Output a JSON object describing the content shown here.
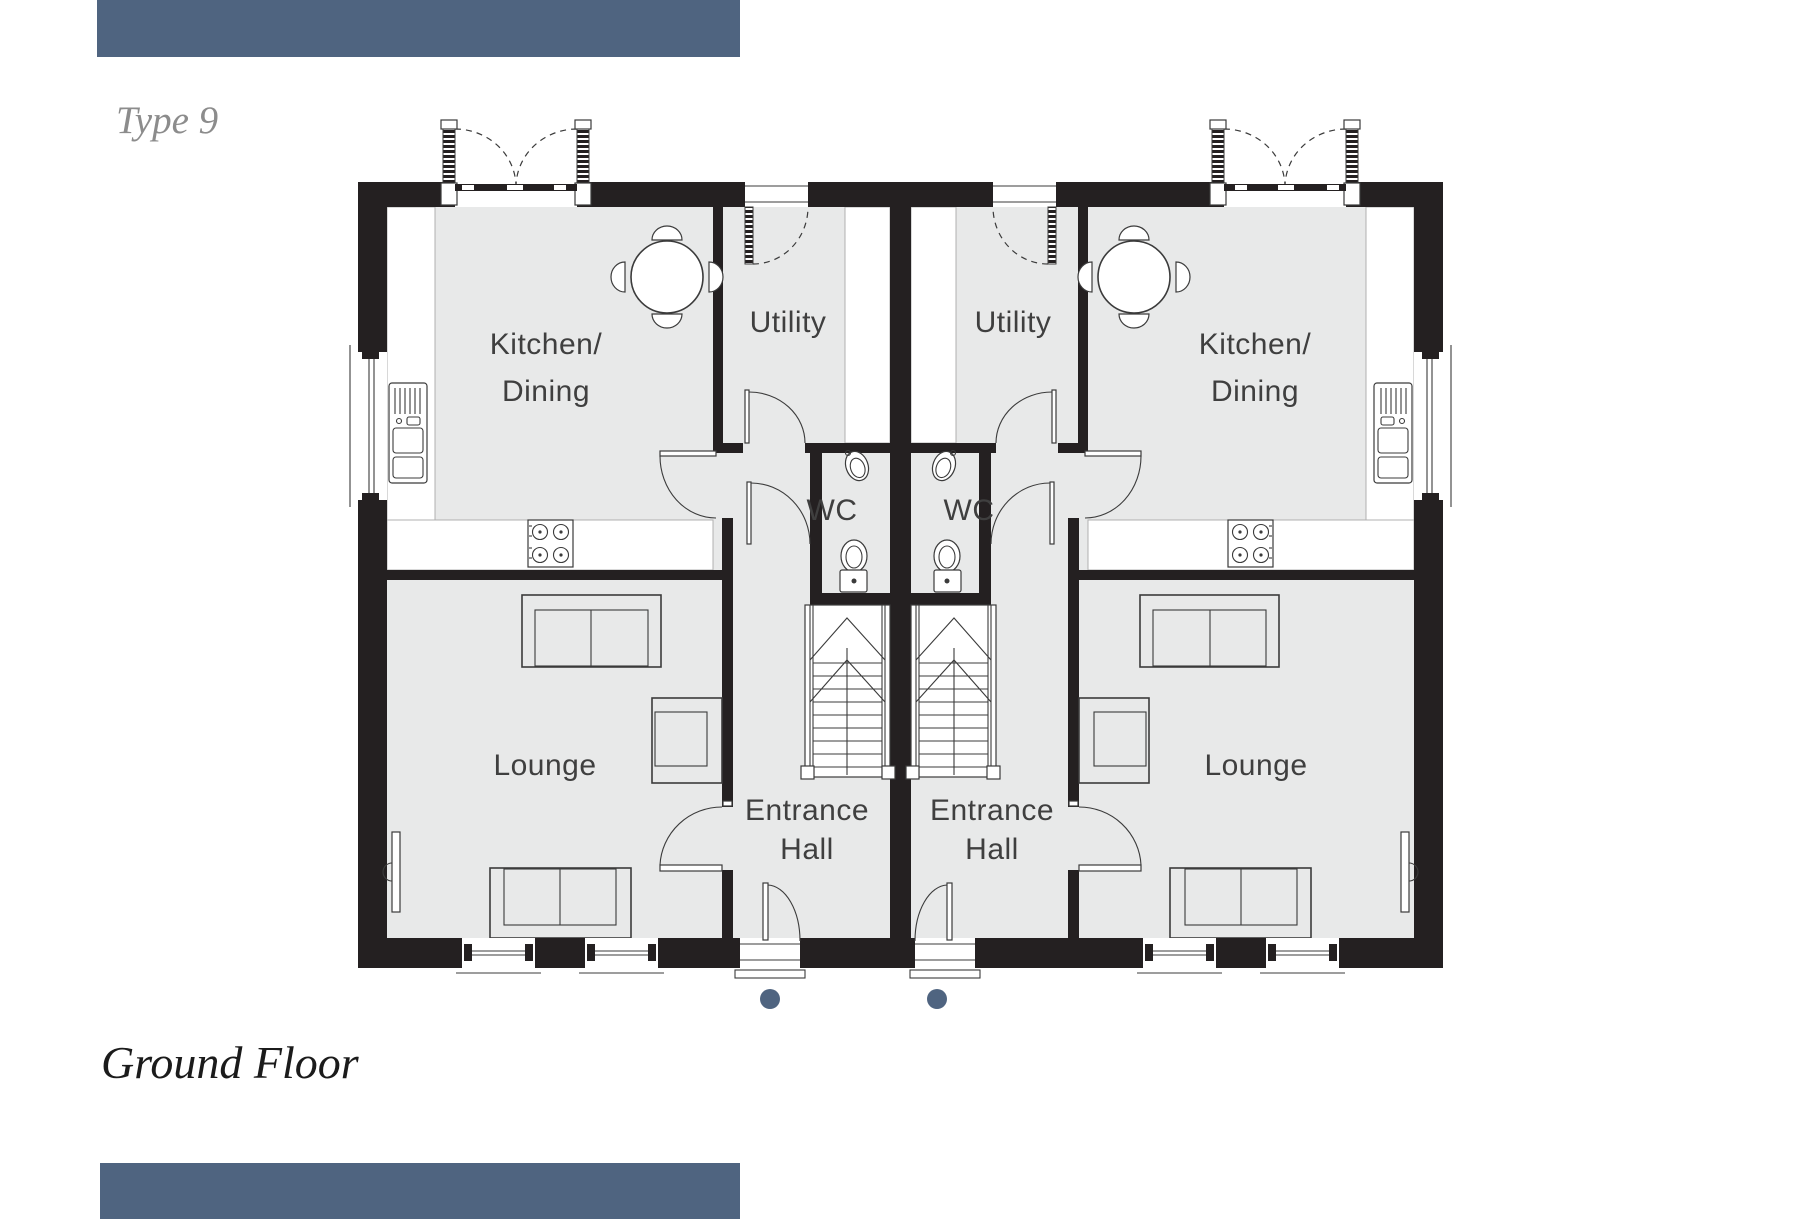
{
  "page": {
    "title": "Type 9",
    "caption": "Ground Floor"
  },
  "colors": {
    "accent": "#4f6480",
    "wall": "#242021",
    "floor": "#e8e9e9",
    "line": "#3b3b3b",
    "label": "#3f3f3f",
    "title_gray": "#8c8c8c",
    "caption_dark": "#1b1b1b"
  },
  "plan": {
    "rooms": [
      {
        "id": "kitchen-dining-left",
        "label": "Kitchen/\nDining"
      },
      {
        "id": "utility-left",
        "label": "Utility"
      },
      {
        "id": "wc-left",
        "label": "WC"
      },
      {
        "id": "entrance-hall-left",
        "label": "Entrance\nHall"
      },
      {
        "id": "lounge-left",
        "label": "Lounge"
      },
      {
        "id": "kitchen-dining-right",
        "label": "Kitchen/\nDining"
      },
      {
        "id": "utility-right",
        "label": "Utility"
      },
      {
        "id": "wc-right",
        "label": "WC"
      },
      {
        "id": "entrance-hall-right",
        "label": "Entrance\nHall"
      },
      {
        "id": "lounge-right",
        "label": "Lounge"
      }
    ],
    "markers": {
      "front_door_dots": 2,
      "dot_color": "#4f6480"
    }
  }
}
